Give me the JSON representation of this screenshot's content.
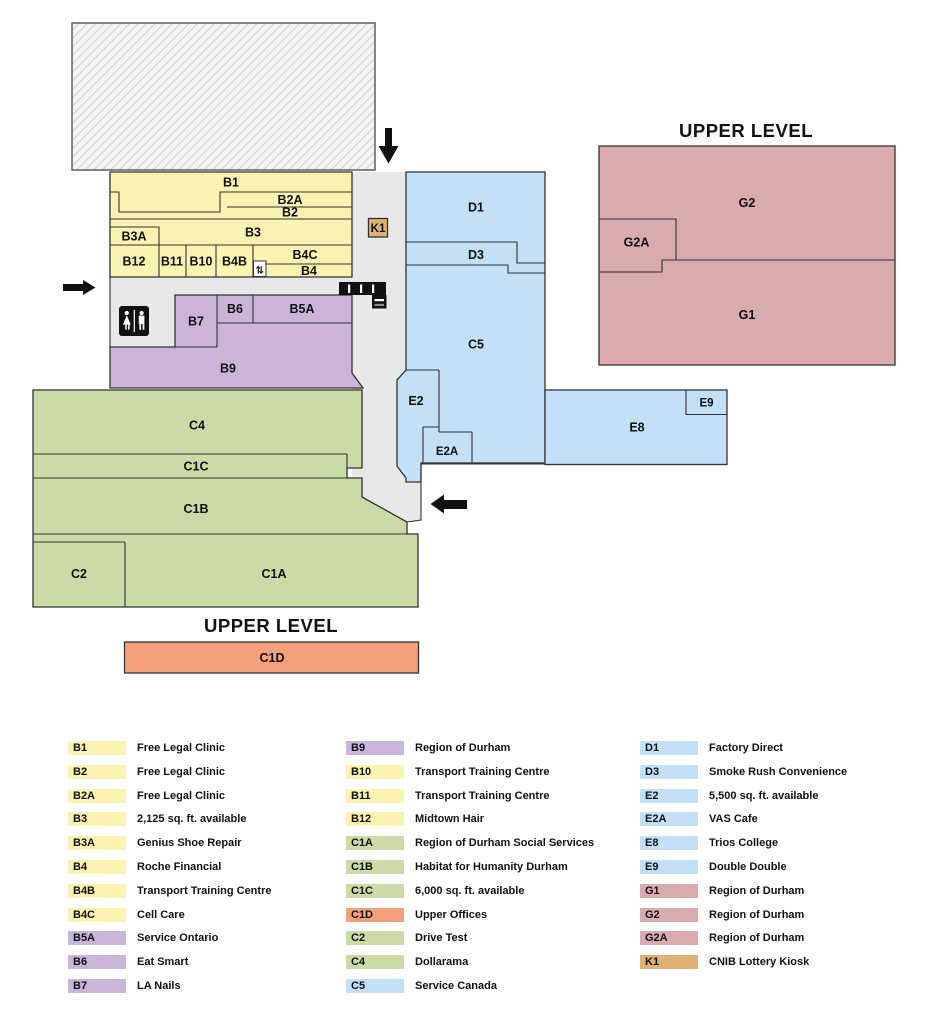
{
  "colors": {
    "yellow": "#FBF3B1",
    "purple": "#CAB5D8",
    "green": "#C9DCA8",
    "blue": "#C2E0F8",
    "pink": "#D9ABAE",
    "orange": "#F5A07C",
    "tan": "#E0B175",
    "corridor": "#E8E8E8",
    "icon_black": "#111111"
  },
  "map": {
    "title_upper_right": "UPPER LEVEL",
    "title_upper_bottom": "UPPER LEVEL",
    "units": {
      "b1": "B1",
      "b2": "B2",
      "b2a": "B2A",
      "b3": "B3",
      "b3a": "B3A",
      "b4": "B4",
      "b4b": "B4B",
      "b4c": "B4C",
      "b5a": "B5A",
      "b6": "B6",
      "b7": "B7",
      "b9": "B9",
      "b10": "B10",
      "b11": "B11",
      "b12": "B12",
      "c1a": "C1A",
      "c1b": "C1B",
      "c1c": "C1C",
      "c1d": "C1D",
      "c2": "C2",
      "c4": "C4",
      "c5": "C5",
      "d1": "D1",
      "d3": "D3",
      "e2": "E2",
      "e2a": "E2A",
      "e8": "E8",
      "e9": "E9",
      "g1": "G1",
      "g2": "G2",
      "g2a": "G2A",
      "k1": "K1"
    },
    "icons": {
      "stairs_glyph": "⇅",
      "restroom": "restroom",
      "escalator": "escalator",
      "entrance_arrows": [
        "down",
        "right",
        "left"
      ]
    }
  },
  "legend": {
    "columns": [
      {
        "items": [
          {
            "code": "B1",
            "name": "Free Legal Clinic",
            "color": "#FBF3B1"
          },
          {
            "code": "B2",
            "name": "Free Legal Clinic",
            "color": "#FBF3B1"
          },
          {
            "code": "B2A",
            "name": "Free Legal Clinic",
            "color": "#FBF3B1"
          },
          {
            "code": "B3",
            "name": "2,125 sq. ft. available",
            "color": "#FBF3B1"
          },
          {
            "code": "B3A",
            "name": "Genius Shoe Repair",
            "color": "#FBF3B1"
          },
          {
            "code": "B4",
            "name": "Roche Financial",
            "color": "#FBF3B1"
          },
          {
            "code": "B4B",
            "name": "Transport Training Centre",
            "color": "#FBF3B1"
          },
          {
            "code": "B4C",
            "name": "Cell Care",
            "color": "#FBF3B1"
          },
          {
            "code": "B5A",
            "name": "Service Ontario",
            "color": "#CAB5D8"
          },
          {
            "code": "B6",
            "name": "Eat Smart",
            "color": "#CAB5D8"
          },
          {
            "code": "B7",
            "name": "LA Nails",
            "color": "#CAB5D8"
          }
        ]
      },
      {
        "items": [
          {
            "code": "B9",
            "name": "Region of Durham",
            "color": "#CAB5D8"
          },
          {
            "code": "B10",
            "name": "Transport Training Centre",
            "color": "#FBF3B1"
          },
          {
            "code": "B11",
            "name": "Transport Training Centre",
            "color": "#FBF3B1"
          },
          {
            "code": "B12",
            "name": "Midtown Hair",
            "color": "#FBF3B1"
          },
          {
            "code": "C1A",
            "name": "Region of Durham Social Services",
            "color": "#C9DCA8"
          },
          {
            "code": "C1B",
            "name": "Habitat for Humanity Durham",
            "color": "#C9DCA8"
          },
          {
            "code": "C1C",
            "name": "6,000 sq. ft. available",
            "color": "#C9DCA8"
          },
          {
            "code": "C1D",
            "name": "Upper Offices",
            "color": "#F5A07C"
          },
          {
            "code": "C2",
            "name": "Drive Test",
            "color": "#C9DCA8"
          },
          {
            "code": "C4",
            "name": "Dollarama",
            "color": "#C9DCA8"
          },
          {
            "code": "C5",
            "name": "Service Canada",
            "color": "#C2E0F8"
          }
        ]
      },
      {
        "items": [
          {
            "code": "D1",
            "name": "Factory Direct",
            "color": "#C2E0F8"
          },
          {
            "code": "D3",
            "name": "Smoke Rush Convenience",
            "color": "#C2E0F8"
          },
          {
            "code": "E2",
            "name": "5,500 sq. ft. available",
            "color": "#C2E0F8"
          },
          {
            "code": "E2A",
            "name": "VAS Cafe",
            "color": "#C2E0F8"
          },
          {
            "code": "E8",
            "name": "Trios College",
            "color": "#C2E0F8"
          },
          {
            "code": "E9",
            "name": "Double Double",
            "color": "#C2E0F8"
          },
          {
            "code": "G1",
            "name": "Region of Durham",
            "color": "#D9ABAE"
          },
          {
            "code": "G2",
            "name": "Region of Durham",
            "color": "#D9ABAE"
          },
          {
            "code": "G2A",
            "name": "Region of Durham",
            "color": "#D9ABAE"
          },
          {
            "code": "K1",
            "name": "CNIB Lottery Kiosk",
            "color": "#E0B175"
          }
        ]
      }
    ]
  }
}
